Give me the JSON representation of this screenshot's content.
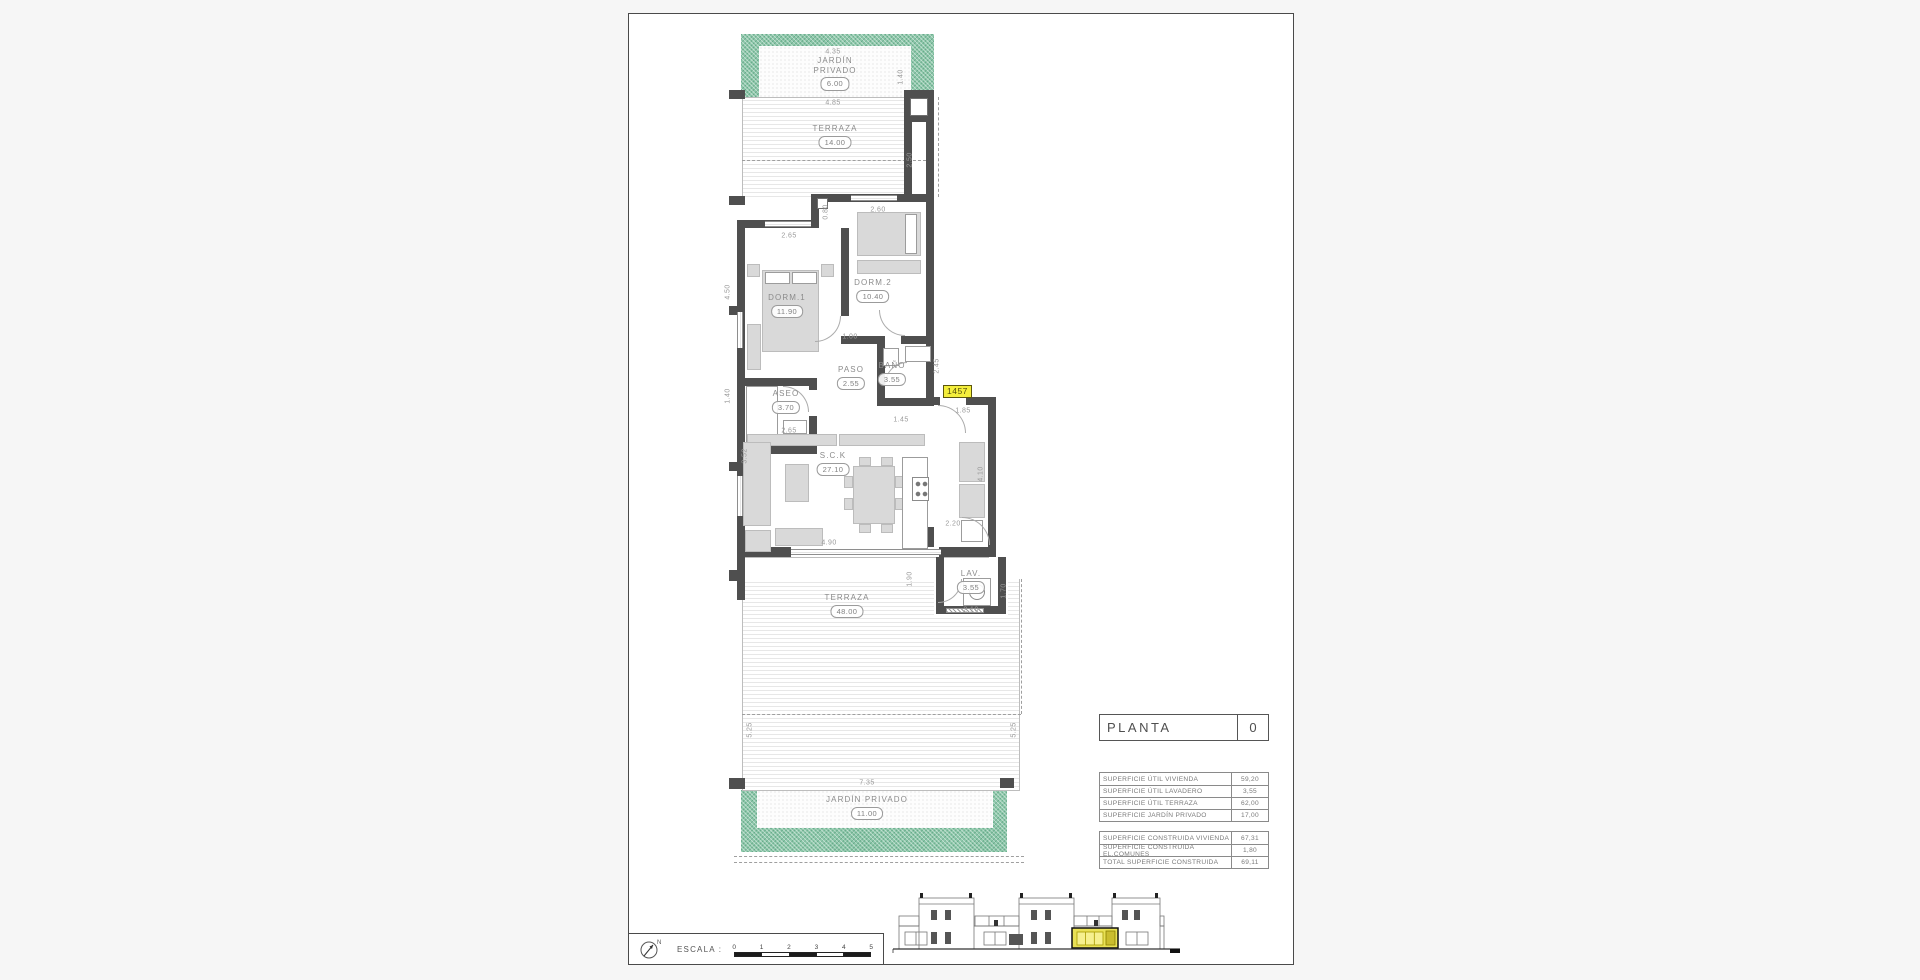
{
  "colors": {
    "garden_green": "#8cc7a9",
    "highlight_yellow": "#e9e155",
    "badge_yellow": "#f4ee3c",
    "wall_gray": "#4f4f4f"
  },
  "title_block": {
    "label": "PLANTA",
    "value": "0"
  },
  "tables": {
    "superficie_util": [
      [
        "SUPERFICIE ÚTIL VIVIENDA",
        "59,20"
      ],
      [
        "SUPERFICIE ÚTIL LAVADERO",
        "3,55"
      ],
      [
        "SUPERFICIE ÚTIL TERRAZA",
        "62,00"
      ],
      [
        "SUPERFICIE JARDÍN PRIVADO",
        "17,00"
      ]
    ],
    "superficie_construida": [
      [
        "SUPERFICIE CONSTRUIDA VIVIENDA",
        "67,31"
      ],
      [
        "SUPERFICIE CONSTRUIDA EL.COMUNES",
        "1,80"
      ],
      [
        "TOTAL SUPERFICIE CONSTRUIDA",
        "69,11"
      ]
    ]
  },
  "scale_bar": {
    "label": "ESCALA :",
    "ticks": [
      "0",
      "1",
      "2",
      "3",
      "4",
      "5"
    ]
  },
  "plan": {
    "badge": {
      "t": "1457",
      "x": 314,
      "y": 371
    },
    "labels": [
      {
        "lines": [
          "JARDÍN",
          "PRIVADO"
        ],
        "v": "6.00",
        "x": 206,
        "y": 42
      },
      {
        "lines": [
          "TERRAZA"
        ],
        "v": "14.00",
        "x": 206,
        "y": 110
      },
      {
        "lines": [
          "DORM.1"
        ],
        "v": "11.90",
        "x": 158,
        "y": 279
      },
      {
        "lines": [
          "DORM.2"
        ],
        "v": "10.40",
        "x": 244,
        "y": 264
      },
      {
        "lines": [
          "PASO"
        ],
        "v": "2.55",
        "x": 222,
        "y": 351
      },
      {
        "lines": [
          "BAÑO"
        ],
        "v": "3.55",
        "x": 263,
        "y": 347
      },
      {
        "lines": [
          "ASEO"
        ],
        "v": "3.70",
        "x": 157,
        "y": 375
      },
      {
        "lines": [
          "S.C.K"
        ],
        "v": "27.10",
        "x": 204,
        "y": 437
      },
      {
        "lines": [
          "LAV."
        ],
        "v": "3.55",
        "x": 342,
        "y": 555
      },
      {
        "lines": [
          "TERRAZA"
        ],
        "v": "48.00",
        "x": 218,
        "y": 579
      },
      {
        "lines": [
          "JARDÍN PRIVADO"
        ],
        "v": "11.00",
        "x": 238,
        "y": 781
      }
    ],
    "dims": [
      {
        "t": "4.35",
        "x": 204,
        "y": 38
      },
      {
        "t": "1.40",
        "x": 272,
        "y": 63,
        "r": 1
      },
      {
        "t": "4.85",
        "x": 204,
        "y": 89
      },
      {
        "t": "2.50",
        "x": 281,
        "y": 146,
        "r": 1
      },
      {
        "t": "0.80",
        "x": 197,
        "y": 198,
        "r": 1
      },
      {
        "t": "2.60",
        "x": 249,
        "y": 196
      },
      {
        "t": "2.65",
        "x": 160,
        "y": 222
      },
      {
        "t": "4.50",
        "x": 99,
        "y": 278,
        "r": 1
      },
      {
        "t": "1.00",
        "x": 221,
        "y": 323
      },
      {
        "t": "2.45",
        "x": 308,
        "y": 352,
        "r": 1
      },
      {
        "t": "1.45",
        "x": 272,
        "y": 406
      },
      {
        "t": "1.40",
        "x": 99,
        "y": 382,
        "r": 1
      },
      {
        "t": "2.65",
        "x": 160,
        "y": 417
      },
      {
        "t": "1.85",
        "x": 334,
        "y": 397
      },
      {
        "t": "3.52",
        "x": 116,
        "y": 442,
        "r": 1
      },
      {
        "t": "4.10",
        "x": 352,
        "y": 460,
        "r": 1
      },
      {
        "t": "4.90",
        "x": 200,
        "y": 529
      },
      {
        "t": "2.20",
        "x": 324,
        "y": 510
      },
      {
        "t": "1.90",
        "x": 281,
        "y": 565,
        "r": 1
      },
      {
        "t": "2.10",
        "x": 342,
        "y": 596
      },
      {
        "t": "1.70",
        "x": 375,
        "y": 577,
        "r": 1
      },
      {
        "t": "5.25",
        "x": 121,
        "y": 716,
        "r": 1
      },
      {
        "t": "5.25",
        "x": 385,
        "y": 716,
        "r": 1
      },
      {
        "t": "7.35",
        "x": 238,
        "y": 769
      }
    ],
    "geometry": {
      "green": [
        [
          112,
          20,
          193,
          63
        ],
        [
          112,
          776,
          266,
          62
        ]
      ],
      "dots": [
        [
          130,
          32,
          152,
          51
        ],
        [
          128,
          776,
          236,
          38
        ]
      ],
      "deck": [
        [
          113,
          83,
          162,
          100
        ],
        [
          113,
          565,
          277,
          211
        ]
      ],
      "wfill": [
        [
          305,
          541,
          74,
          61
        ]
      ],
      "lines": [
        [
          113,
          83,
          163,
          1
        ],
        [
          113,
          83,
          1,
          100
        ],
        [
          113,
          565,
          1,
          212
        ],
        [
          390,
          565,
          1,
          212
        ],
        [
          113,
          776,
          278,
          1
        ],
        [
          108,
          543,
          252,
          1
        ]
      ],
      "dashes": [
        [
          113,
          146,
          184,
          "h"
        ],
        [
          309,
          83,
          100,
          "v"
        ],
        [
          113,
          700,
          279,
          "h"
        ],
        [
          392,
          565,
          135,
          "v"
        ],
        [
          105,
          842,
          290,
          "h"
        ],
        [
          105,
          848,
          290,
          "h"
        ]
      ],
      "walls": [
        [
          275,
          76,
          30,
          8
        ],
        [
          275,
          76,
          8,
          112
        ],
        [
          297,
          76,
          8,
          112
        ],
        [
          275,
          102,
          30,
          6
        ],
        [
          182,
          180,
          123,
          8
        ],
        [
          182,
          180,
          8,
          34
        ],
        [
          108,
          206,
          82,
          8
        ],
        [
          108,
          206,
          8,
          380
        ],
        [
          297,
          188,
          8,
          197
        ],
        [
          212,
          214,
          8,
          88
        ],
        [
          212,
          322,
          44,
          8
        ],
        [
          272,
          322,
          33,
          8
        ],
        [
          248,
          330,
          8,
          62
        ],
        [
          248,
          384,
          57,
          8
        ],
        [
          116,
          364,
          66,
          8
        ],
        [
          180,
          364,
          8,
          12
        ],
        [
          180,
          402,
          8,
          38
        ],
        [
          108,
          432,
          80,
          8
        ],
        [
          297,
          383,
          14,
          8
        ],
        [
          337,
          383,
          30,
          8
        ],
        [
          359,
          383,
          8,
          160
        ],
        [
          291,
          513,
          14,
          20
        ],
        [
          108,
          533,
          54,
          10
        ],
        [
          310,
          533,
          57,
          10
        ],
        [
          307,
          543,
          8,
          57
        ],
        [
          369,
          543,
          8,
          57
        ],
        [
          307,
          592,
          70,
          8
        ]
      ],
      "wbox": [
        [
          281,
          84,
          18,
          18
        ],
        [
          188,
          184,
          11,
          11
        ]
      ],
      "ticks": [
        [
          100,
          76,
          16,
          9
        ],
        [
          100,
          182,
          16,
          9
        ],
        [
          100,
          292,
          16,
          9
        ],
        [
          100,
          448,
          16,
          9
        ],
        [
          100,
          556,
          16,
          11
        ],
        [
          100,
          764,
          16,
          11
        ],
        [
          371,
          764,
          14,
          10
        ]
      ],
      "furniture": [
        [
          118,
          250,
          13,
          13
        ],
        [
          192,
          250,
          13,
          13
        ],
        [
          133,
          256,
          57,
          82
        ],
        [
          136,
          258,
          25,
          12,
          "w"
        ],
        [
          163,
          258,
          25,
          12,
          "w"
        ],
        [
          118,
          310,
          14,
          46
        ],
        [
          228,
          198,
          64,
          44
        ],
        [
          276,
          200,
          12,
          40,
          "w"
        ],
        [
          228,
          246,
          64,
          14
        ],
        [
          117,
          372,
          32,
          58,
          "w"
        ],
        [
          154,
          406,
          24,
          14,
          "w"
        ],
        [
          276,
          332,
          26,
          16,
          "w"
        ],
        [
          254,
          334,
          16,
          18,
          "w"
        ],
        [
          118,
          420,
          90,
          12
        ],
        [
          210,
          420,
          86,
          12
        ],
        [
          114,
          428,
          28,
          84
        ],
        [
          116,
          516,
          26,
          22
        ],
        [
          146,
          514,
          48,
          18
        ],
        [
          156,
          450,
          24,
          38
        ],
        [
          224,
          452,
          42,
          58
        ],
        [
          230,
          443,
          12,
          9
        ],
        [
          252,
          443,
          12,
          9
        ],
        [
          215,
          462,
          9,
          12
        ],
        [
          215,
          484,
          9,
          12
        ],
        [
          266,
          462,
          9,
          12
        ],
        [
          266,
          484,
          9,
          12
        ],
        [
          230,
          510,
          12,
          9
        ],
        [
          252,
          510,
          12,
          9
        ],
        [
          273,
          443,
          26,
          92,
          "w"
        ],
        [
          283,
          463,
          17,
          24,
          "hob"
        ],
        [
          330,
          428,
          26,
          40
        ],
        [
          330,
          470,
          26,
          34
        ],
        [
          332,
          506,
          22,
          22,
          "w"
        ],
        [
          334,
          564,
          28,
          28,
          "w"
        ],
        [
          340,
          570,
          16,
          16,
          "wash"
        ]
      ],
      "windows": [
        [
          222,
          181,
          46,
          6,
          "h"
        ],
        [
          136,
          207,
          46,
          6,
          "h"
        ],
        [
          108,
          298,
          6,
          36,
          "v"
        ],
        [
          108,
          462,
          6,
          40,
          "v"
        ],
        [
          162,
          535,
          150,
          6,
          "h"
        ]
      ],
      "vents": [
        [
          317,
          594,
          38,
          5
        ]
      ],
      "arcs": [
        [
          186,
          302,
          26,
          "br"
        ],
        [
          250,
          296,
          26,
          "bl"
        ],
        [
          256,
          348,
          22,
          "tl"
        ],
        [
          154,
          372,
          26,
          "tr"
        ],
        [
          309,
          391,
          28,
          "tr"
        ],
        [
          333,
          503,
          28,
          "tr"
        ],
        [
          309,
          565,
          24,
          "br"
        ]
      ]
    }
  }
}
